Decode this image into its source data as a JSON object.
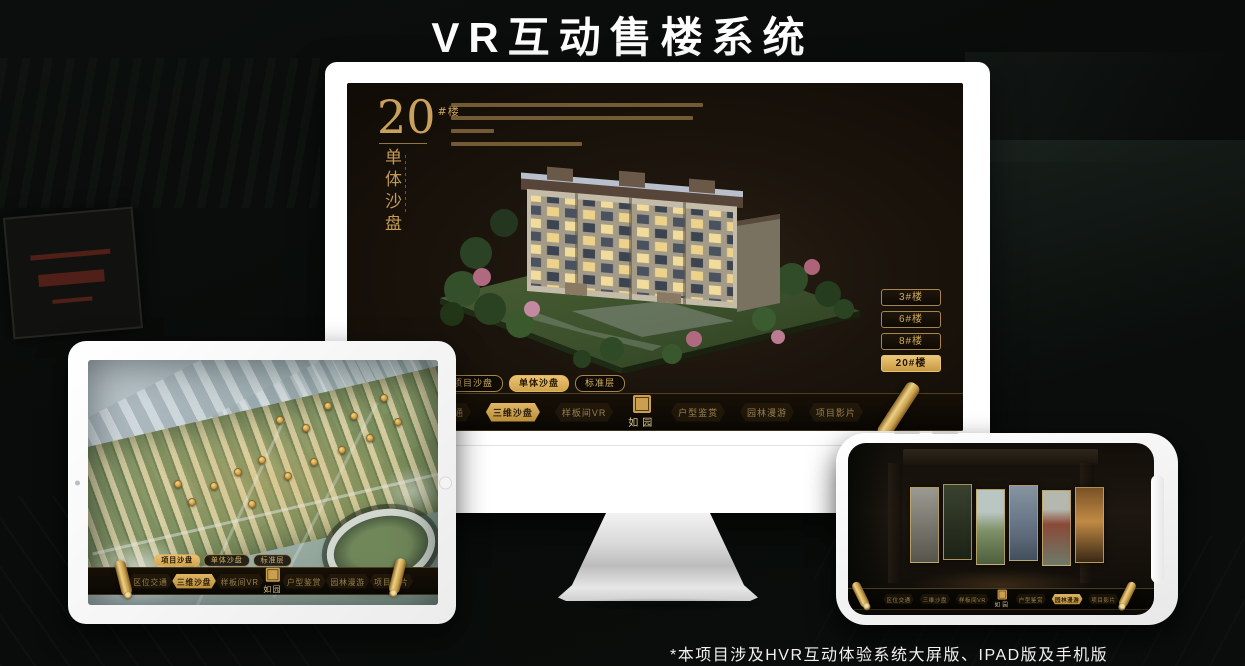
{
  "page": {
    "title": "VR互动售楼系统",
    "footnote": "*本项目涉及HVR互动体验系统大屏版、IPAD版及手机版"
  },
  "colors": {
    "gold": "#d2a95c",
    "gold_active": "#e0b765",
    "screen_dark": "#1b140c",
    "text_on_gold": "#241806"
  },
  "monitor": {
    "heading": {
      "number": "20",
      "suffix": "#楼",
      "subtitle_vertical": "单体沙盘"
    },
    "floor_buttons": [
      {
        "label": "3#楼",
        "active": false
      },
      {
        "label": "6#楼",
        "active": false
      },
      {
        "label": "8#楼",
        "active": false
      },
      {
        "label": "20#楼",
        "active": true
      }
    ],
    "sub_tabs": [
      {
        "label": "项目沙盘",
        "active": false
      },
      {
        "label": "单体沙盘",
        "active": true
      },
      {
        "label": "标准层",
        "active": false
      }
    ],
    "nav": {
      "logo": "如园",
      "items": [
        {
          "label": "区位交通",
          "active": false
        },
        {
          "label": "三维沙盘",
          "active": true
        },
        {
          "label": "样板间VR",
          "active": false
        },
        {
          "label": "户型鉴赏",
          "active": false
        },
        {
          "label": "园林漫游",
          "active": false
        },
        {
          "label": "项目影片",
          "active": false
        }
      ]
    }
  },
  "tablet": {
    "sub_tabs": [
      {
        "label": "项目沙盘",
        "active": true
      },
      {
        "label": "单体沙盘",
        "active": false
      },
      {
        "label": "标准层",
        "active": false
      }
    ],
    "nav": {
      "logo": "如园",
      "items": [
        {
          "label": "区位交通",
          "active": false
        },
        {
          "label": "三维沙盘",
          "active": true
        },
        {
          "label": "样板间VR",
          "active": false
        },
        {
          "label": "户型鉴赏",
          "active": false
        },
        {
          "label": "园林漫游",
          "active": false
        },
        {
          "label": "项目影片",
          "active": false
        }
      ]
    }
  },
  "phone": {
    "nav": {
      "logo": "如园",
      "items": [
        {
          "label": "区位交通",
          "active": false
        },
        {
          "label": "三维沙盘",
          "active": false
        },
        {
          "label": "样板间VR",
          "active": false
        },
        {
          "label": "户型鉴赏",
          "active": false
        },
        {
          "label": "园林漫游",
          "active": true
        },
        {
          "label": "项目影片",
          "active": false
        }
      ]
    }
  }
}
